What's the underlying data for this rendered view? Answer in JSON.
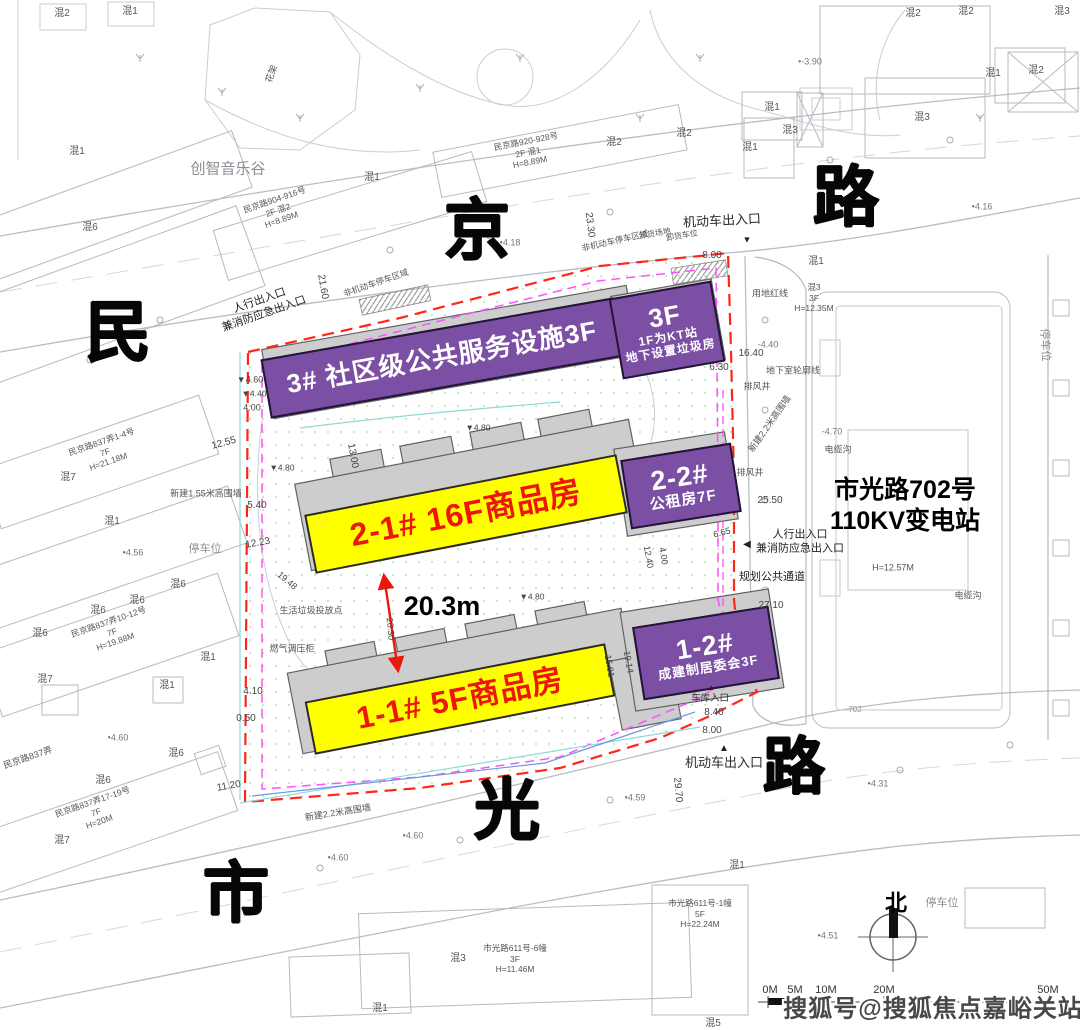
{
  "colors": {
    "purple": "#7b4fa3",
    "yellow": "#ffff00",
    "banner_red": "#ee1509",
    "boundary_red": "#ff2619",
    "magenta": "#ff4fff",
    "road_text": "#060606"
  },
  "road_labels": [
    {
      "t": "民",
      "x": 118,
      "y": 332,
      "s": 66
    },
    {
      "t": "京",
      "x": 477,
      "y": 230,
      "s": 66
    },
    {
      "t": "路",
      "x": 846,
      "y": 197,
      "s": 66
    },
    {
      "t": "市",
      "x": 236,
      "y": 893,
      "s": 66
    },
    {
      "t": "光",
      "x": 507,
      "y": 810,
      "s": 66
    },
    {
      "t": "路",
      "x": 794,
      "y": 768,
      "s": 62
    }
  ],
  "banners": [
    {
      "name": "banner-3",
      "style": "purple",
      "cx": 442,
      "cy": 358,
      "w": 354,
      "h": 56,
      "rot": -10,
      "lines": [
        {
          "text": "3#   社区级公共服务设施3F",
          "size": 26
        }
      ]
    },
    {
      "name": "banner-3f",
      "style": "purple",
      "cx": 667,
      "cy": 330,
      "w": 100,
      "h": 78,
      "rot": -10,
      "lines": [
        {
          "text": "3F",
          "size": 26
        },
        {
          "text": "1F为KT站",
          "size": 12
        },
        {
          "text": "地下设置垃圾房",
          "size": 12
        }
      ]
    },
    {
      "name": "banner-2-1",
      "style": "yellow",
      "cx": 466,
      "cy": 514,
      "w": 314,
      "h": 56,
      "rot": -11,
      "lines": [
        {
          "text": "2-1#    16F商品房",
          "size": 32
        }
      ]
    },
    {
      "name": "banner-2-2",
      "style": "purple",
      "cx": 681,
      "cy": 486,
      "w": 108,
      "h": 66,
      "rot": -9,
      "lines": [
        {
          "text": "2-2#",
          "size": 27
        },
        {
          "text": "公租房7F",
          "size": 15
        }
      ]
    },
    {
      "name": "banner-1-1",
      "style": "yellow",
      "cx": 460,
      "cy": 699,
      "w": 302,
      "h": 50,
      "rot": -11,
      "lines": [
        {
          "text": "1-1#    5F商品房",
          "size": 31
        }
      ]
    },
    {
      "name": "banner-1-2",
      "style": "purple",
      "cx": 706,
      "cy": 653,
      "w": 134,
      "h": 70,
      "rot": -9,
      "lines": [
        {
          "text": "1-2#",
          "size": 27
        },
        {
          "text": "成建制居委会3F",
          "size": 13
        }
      ]
    }
  ],
  "watermark": {
    "text": "搜狐号@搜狐焦点嘉峪关站",
    "x": 933,
    "y": 1006
  },
  "scalebar": {
    "label_y": 991,
    "ticks": [
      {
        "t": "0M",
        "x": 770
      },
      {
        "t": "5M",
        "x": 795
      },
      {
        "t": "10M",
        "x": 826
      },
      {
        "t": "20M",
        "x": 884
      },
      {
        "t": "50M",
        "x": 1048
      }
    ]
  },
  "annotations": [
    {
      "t": "混2",
      "x": 62,
      "y": 14
    },
    {
      "t": "混1",
      "x": 130,
      "y": 12
    },
    {
      "t": "混1",
      "x": 77,
      "y": 152
    },
    {
      "t": "混6",
      "x": 90,
      "y": 228
    },
    {
      "t": "创智音乐谷",
      "x": 228,
      "y": 170,
      "s": 15,
      "c": "#8a8e93"
    },
    {
      "t": "花架",
      "x": 272,
      "y": 74,
      "s": 9,
      "r": -70
    },
    {
      "t": "民京路904-916号\n2F    混2\nH=8.89M",
      "x": 278,
      "y": 210,
      "s": 8.5,
      "r": -19
    },
    {
      "t": "混1",
      "x": 372,
      "y": 178
    },
    {
      "t": "民京路920-928号\n2F    混1\nH=8.89M",
      "x": 528,
      "y": 152,
      "s": 8.5,
      "r": -11
    },
    {
      "t": "混2",
      "x": 614,
      "y": 143
    },
    {
      "t": "混2",
      "x": 684,
      "y": 134
    },
    {
      "t": "混2",
      "x": 913,
      "y": 14
    },
    {
      "t": "混2",
      "x": 966,
      "y": 12
    },
    {
      "t": "混3",
      "x": 1062,
      "y": 12
    },
    {
      "t": "混1",
      "x": 993,
      "y": 74
    },
    {
      "t": "混2",
      "x": 1036,
      "y": 71
    },
    {
      "t": "混1",
      "x": 772,
      "y": 108
    },
    {
      "t": "混3",
      "x": 790,
      "y": 131
    },
    {
      "t": "混1",
      "x": 750,
      "y": 148
    },
    {
      "t": "混3",
      "x": 922,
      "y": 118
    },
    {
      "t": "混1",
      "x": 816,
      "y": 262
    },
    {
      "t": "•-3.90",
      "x": 810,
      "y": 62,
      "s": 9,
      "c": "#777"
    },
    {
      "t": "•4.16",
      "x": 982,
      "y": 207,
      "s": 9,
      "c": "#777"
    },
    {
      "t": "•4.18",
      "x": 510,
      "y": 243,
      "s": 9,
      "c": "#777"
    },
    {
      "t": "机动车出入口",
      "x": 722,
      "y": 221,
      "s": 13,
      "c": "#2b2b2b",
      "r": -3,
      "n": "entrance-label"
    },
    {
      "t": "▼",
      "x": 747,
      "y": 240,
      "s": 9,
      "c": "#222"
    },
    {
      "t": "8.00",
      "x": 712,
      "y": 256,
      "c": "#444"
    },
    {
      "t": "23.30",
      "x": 589,
      "y": 225,
      "r": 83,
      "c": "#444"
    },
    {
      "t": "21.60",
      "x": 322,
      "y": 287,
      "r": 80,
      "c": "#444"
    },
    {
      "t": "非机动车停车区域",
      "x": 615,
      "y": 241,
      "s": 8.5,
      "r": -13
    },
    {
      "t": "非机动车停车区域",
      "x": 376,
      "y": 283,
      "s": 8.5,
      "r": -19
    },
    {
      "t": "卸货场地",
      "x": 655,
      "y": 234,
      "s": 8,
      "r": -10
    },
    {
      "t": "卸货车位",
      "x": 682,
      "y": 236,
      "s": 8,
      "r": -10
    },
    {
      "t": "用地红线",
      "x": 770,
      "y": 294,
      "s": 9
    },
    {
      "t": "人行出入口\n兼消防应急出入口",
      "x": 262,
      "y": 308,
      "s": 11,
      "c": "#222",
      "r": -19,
      "n": "entrance-label"
    },
    {
      "t": "混3\n3F\nH=12.35M",
      "x": 814,
      "y": 298,
      "s": 8.5
    },
    {
      "t": "▼4.60",
      "x": 250,
      "y": 380,
      "s": 9,
      "c": "#444"
    },
    {
      "t": "▼4.40",
      "x": 254,
      "y": 394,
      "s": 8.5,
      "c": "#444"
    },
    {
      "t": "4.00",
      "x": 252,
      "y": 408,
      "s": 9,
      "c": "#444"
    },
    {
      "t": "12.55",
      "x": 224,
      "y": 444,
      "r": -15,
      "c": "#444"
    },
    {
      "t": "新建1.55米高围墙",
      "x": 206,
      "y": 494,
      "s": 9
    },
    {
      "t": "5.40",
      "x": 257,
      "y": 506,
      "c": "#444"
    },
    {
      "t": "12.23",
      "x": 258,
      "y": 544,
      "r": -10,
      "c": "#444"
    },
    {
      "t": "▼4.80",
      "x": 282,
      "y": 468,
      "s": 8.5,
      "c": "#444"
    },
    {
      "t": "13.00",
      "x": 352,
      "y": 456,
      "r": 80,
      "c": "#444"
    },
    {
      "t": "民京路837弄1-4号\n7F\nH=21.18M",
      "x": 105,
      "y": 452,
      "s": 8.5,
      "r": -19
    },
    {
      "t": "混7",
      "x": 68,
      "y": 478
    },
    {
      "t": "混1",
      "x": 112,
      "y": 522
    },
    {
      "t": "停车位",
      "x": 205,
      "y": 550,
      "s": 11,
      "c": "#8a8e93"
    },
    {
      "t": "•4.56",
      "x": 133,
      "y": 553,
      "s": 9,
      "c": "#777"
    },
    {
      "t": "混6",
      "x": 178,
      "y": 585
    },
    {
      "t": "混6",
      "x": 137,
      "y": 601
    },
    {
      "t": "混6",
      "x": 98,
      "y": 611
    },
    {
      "t": "混6",
      "x": 40,
      "y": 634
    },
    {
      "t": "民京路837弄10-12号\n7F\nH=19.88M",
      "x": 112,
      "y": 632,
      "s": 8.5,
      "r": -19
    },
    {
      "t": "混7",
      "x": 45,
      "y": 680
    },
    {
      "t": "19.48",
      "x": 287,
      "y": 581,
      "r": 40,
      "s": 9,
      "c": "#444"
    },
    {
      "t": "燃气调压柜",
      "x": 292,
      "y": 649,
      "s": 9
    },
    {
      "t": "生活垃圾投放点",
      "x": 311,
      "y": 611,
      "s": 9
    },
    {
      "t": "混1",
      "x": 208,
      "y": 658
    },
    {
      "t": "混1",
      "x": 167,
      "y": 686
    },
    {
      "t": "民京路837弄",
      "x": 28,
      "y": 758,
      "s": 9,
      "r": -19
    },
    {
      "t": "4.10",
      "x": 253,
      "y": 692,
      "c": "#444"
    },
    {
      "t": "0.50",
      "x": 246,
      "y": 719,
      "c": "#444"
    },
    {
      "t": "•4.60",
      "x": 118,
      "y": 738,
      "s": 9,
      "c": "#777"
    },
    {
      "t": "混6",
      "x": 176,
      "y": 754
    },
    {
      "t": "混6",
      "x": 103,
      "y": 781
    },
    {
      "t": "11.20",
      "x": 229,
      "y": 787,
      "r": -10,
      "c": "#444"
    },
    {
      "t": "民京路837弄17-19号\n7F\nH=20M",
      "x": 96,
      "y": 812,
      "s": 8.5,
      "r": -19
    },
    {
      "t": "混7",
      "x": 62,
      "y": 841
    },
    {
      "t": "新建2.2米高围墙",
      "x": 338,
      "y": 813,
      "s": 9,
      "r": -9
    },
    {
      "t": "•4.60",
      "x": 413,
      "y": 836,
      "s": 9,
      "c": "#777"
    },
    {
      "t": "•4.60",
      "x": 338,
      "y": 858,
      "s": 9,
      "c": "#777"
    },
    {
      "t": "20.3m",
      "x": 442,
      "y": 607,
      "s": 27,
      "b": 1,
      "c": "#000",
      "n": "distance-label"
    },
    {
      "t": "20.30",
      "x": 390,
      "y": 629,
      "r": 85,
      "s": 9,
      "c": "#444"
    },
    {
      "t": "▼4.80",
      "x": 532,
      "y": 597,
      "s": 8.5,
      "c": "#444"
    },
    {
      "t": "12.40",
      "x": 648,
      "y": 557,
      "r": 80,
      "s": 9,
      "c": "#444"
    },
    {
      "t": "4.00",
      "x": 663,
      "y": 556,
      "r": 80,
      "s": 9,
      "c": "#444"
    },
    {
      "t": "15.91",
      "x": 609,
      "y": 666,
      "r": 80,
      "s": 9,
      "c": "#444"
    },
    {
      "t": "19.14",
      "x": 628,
      "y": 662,
      "r": 80,
      "s": 9,
      "c": "#444"
    },
    {
      "t": "▼4.80",
      "x": 478,
      "y": 428,
      "s": 8.5,
      "c": "#444"
    },
    {
      "t": "16.40",
      "x": 751,
      "y": 354,
      "c": "#444"
    },
    {
      "t": "6.30",
      "x": 719,
      "y": 368,
      "c": "#444"
    },
    {
      "t": "地下室轮廓线",
      "x": 793,
      "y": 371,
      "s": 9
    },
    {
      "t": "排风井",
      "x": 757,
      "y": 387,
      "s": 9
    },
    {
      "t": "排风井",
      "x": 750,
      "y": 473,
      "s": 9
    },
    {
      "t": "新建2.2米高围墙",
      "x": 770,
      "y": 424,
      "s": 9,
      "r": -55
    },
    {
      "t": "-4.40",
      "x": 768,
      "y": 345,
      "s": 9,
      "c": "#777"
    },
    {
      "t": "-4.70",
      "x": 832,
      "y": 432,
      "s": 9,
      "c": "#777"
    },
    {
      "t": "电缆沟",
      "x": 838,
      "y": 450,
      "s": 9
    },
    {
      "t": "电缆沟",
      "x": 968,
      "y": 596,
      "s": 9
    },
    {
      "t": "25.50",
      "x": 770,
      "y": 501,
      "c": "#444"
    },
    {
      "t": "◀",
      "x": 747,
      "y": 545,
      "s": 10,
      "c": "#222"
    },
    {
      "t": "人行出入口\n兼消防应急出入口",
      "x": 800,
      "y": 542,
      "s": 11,
      "c": "#222",
      "n": "entrance-label"
    },
    {
      "t": "规划公共通道",
      "x": 772,
      "y": 578,
      "s": 11,
      "c": "#222"
    },
    {
      "t": "6.65",
      "x": 722,
      "y": 533,
      "r": -15,
      "s": 9,
      "c": "#444"
    },
    {
      "t": "27.10",
      "x": 771,
      "y": 606,
      "c": "#444"
    },
    {
      "t": "市光路702号\n110KV变电站",
      "x": 905,
      "y": 506,
      "s": 25,
      "b": 1,
      "c": "#000",
      "n": "substation-label"
    },
    {
      "t": "H=12.57M",
      "x": 893,
      "y": 568,
      "s": 9
    },
    {
      "t": "停车位",
      "x": 1044,
      "y": 345,
      "s": 11,
      "c": "#8a8e93",
      "r": 87
    },
    {
      "t": "▲",
      "x": 711,
      "y": 688,
      "s": 8,
      "c": "#222"
    },
    {
      "t": "车库入口",
      "x": 710,
      "y": 699,
      "s": 9.5,
      "c": "#333"
    },
    {
      "t": "8.40",
      "x": 714,
      "y": 713,
      "c": "#444"
    },
    {
      "t": "8.00",
      "x": 712,
      "y": 731,
      "c": "#444"
    },
    {
      "t": "▲",
      "x": 724,
      "y": 749,
      "s": 10,
      "c": "#222"
    },
    {
      "t": "机动车出入口",
      "x": 724,
      "y": 763,
      "s": 13,
      "c": "#2b2b2b",
      "n": "entrance-label"
    },
    {
      "t": "29.70",
      "x": 677,
      "y": 790,
      "r": 85,
      "c": "#444"
    },
    {
      "t": "•4.31",
      "x": 878,
      "y": 784,
      "s": 9,
      "c": "#777"
    },
    {
      "t": "•4.59",
      "x": 635,
      "y": 798,
      "s": 9,
      "c": "#777"
    },
    {
      "t": "702",
      "x": 855,
      "y": 710,
      "s": 8,
      "c": "#999"
    },
    {
      "t": "混1",
      "x": 737,
      "y": 866
    },
    {
      "t": "市光路611号-1幢\n5F\nH=22.24M",
      "x": 700,
      "y": 914,
      "s": 8.5
    },
    {
      "t": "•4.51",
      "x": 828,
      "y": 936,
      "s": 9,
      "c": "#777"
    },
    {
      "t": "北",
      "x": 896,
      "y": 903,
      "s": 22,
      "b": 1,
      "c": "#000",
      "n": "north-label"
    },
    {
      "t": "停车位",
      "x": 942,
      "y": 904,
      "s": 11,
      "c": "#8a8e93"
    },
    {
      "t": "混3",
      "x": 458,
      "y": 959
    },
    {
      "t": "市光路611号-6幢\n3F\nH=11.46M",
      "x": 515,
      "y": 959,
      "s": 8.5
    },
    {
      "t": "混1",
      "x": 380,
      "y": 1009
    },
    {
      "t": "混5",
      "x": 713,
      "y": 1024
    }
  ]
}
